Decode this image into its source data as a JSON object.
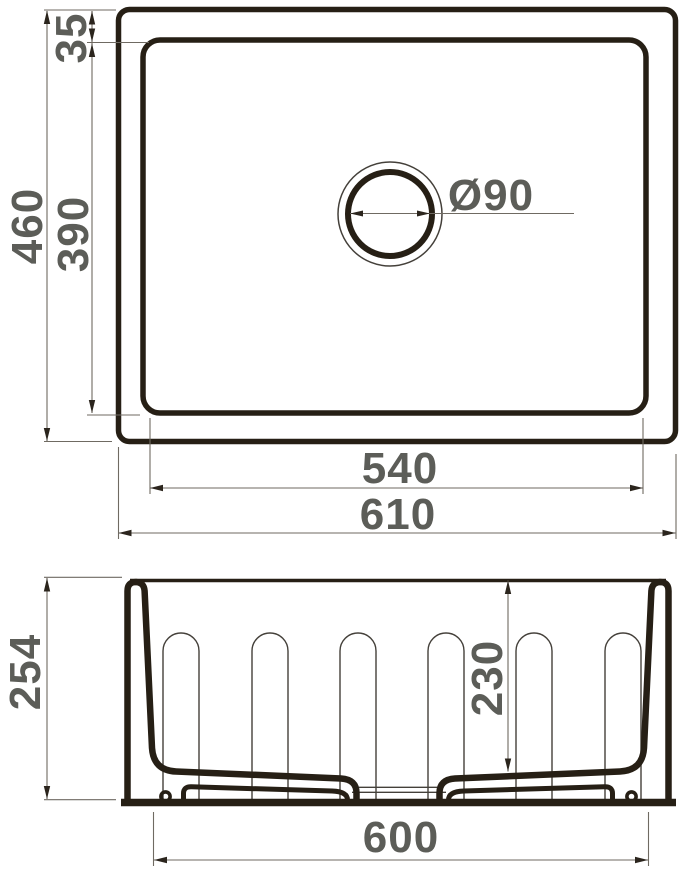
{
  "drawing": {
    "type": "sink-technical-drawing",
    "views": {
      "top": {
        "labels": {
          "overall_depth": "460",
          "bowl_depth": "390",
          "rim_offset": "35",
          "drain_diameter": "Ø90",
          "bowl_width": "540",
          "overall_width": "610"
        }
      },
      "front": {
        "labels": {
          "overall_height": "254",
          "bowl_height": "230",
          "base_width": "600"
        }
      }
    },
    "colors": {
      "outline": "#261f15",
      "thin_line": "#44403a",
      "dimension_line": "#6f6a62",
      "arrow": "#2b251d",
      "label_text": "#5c5d58",
      "background": "#ffffff"
    }
  }
}
